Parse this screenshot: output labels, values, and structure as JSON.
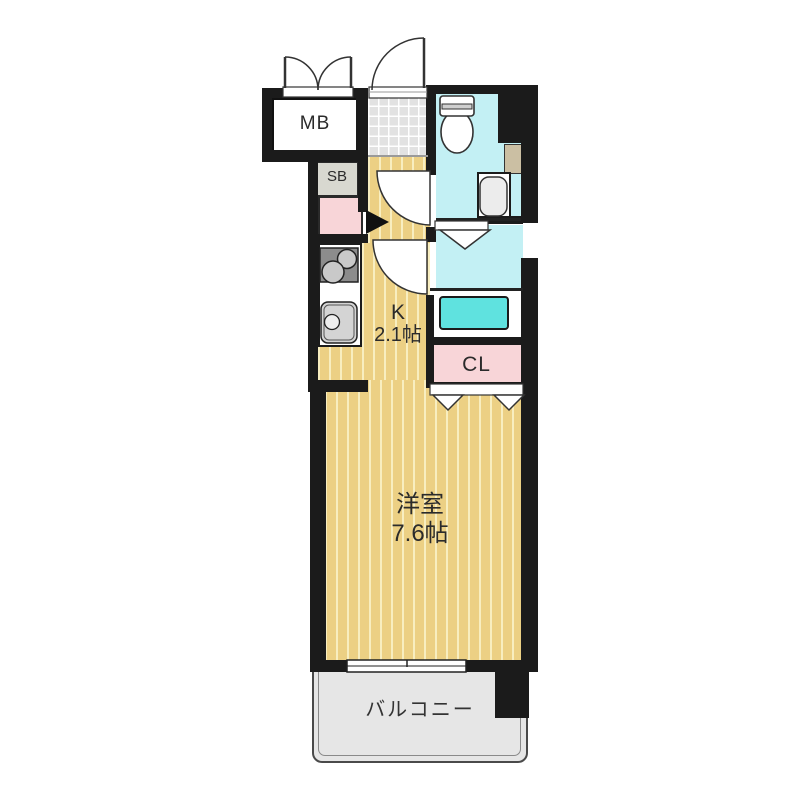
{
  "plan": {
    "type": "apartment-floor-plan",
    "labels": {
      "meter_box": "MB",
      "shoe_box": "SB",
      "kitchen_name": "K",
      "kitchen_size": "2.1帖",
      "closet": "CL",
      "main_room_name": "洋室",
      "main_room_size": "7.6帖",
      "balcony": "バルコニー"
    },
    "colors": {
      "wall": "#1b1b1b",
      "wood_floor": "#ecd084",
      "wood_stripe": "#f8eec0",
      "tile_gray": "#e2e2e2",
      "bath_cyan": "#c3f0f4",
      "washer_pan": "#5fe2df",
      "closet_pink": "#f8d5d8",
      "cabinet_gray": "#d8d8d0",
      "counter_tan": "#cbbfa3",
      "balcony_gray": "#e6e6e6"
    }
  }
}
